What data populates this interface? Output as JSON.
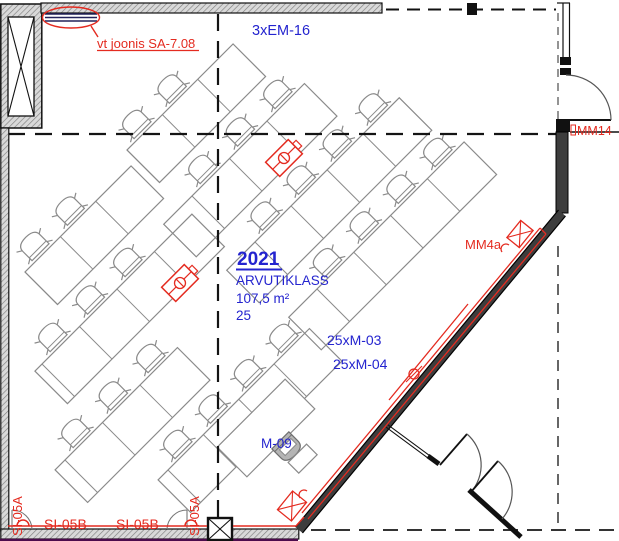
{
  "drawing": {
    "room": {
      "number": "2021",
      "name": "ARVUTIKLASS",
      "area": "107,5 m²",
      "seat_count": "25"
    },
    "annotations": {
      "reference_note": "vt joonis SA-7.08",
      "top_electrical_label": "3xEM-16",
      "right_door_label": "MM14",
      "wall_device_label": "MM4a",
      "equipment_label_1": "25xM-03",
      "equipment_label_2": "25xM-04",
      "teacher_desk_label": "M-09",
      "bottom_pipe_label_1": "SI-05B",
      "bottom_pipe_label_2": "SI-05B",
      "riser_label_left": "SI-05A",
      "riser_label_right": "SI-05A"
    },
    "colors": {
      "annotation_red": "#e42b20",
      "label_blue": "#2424cf",
      "wall_dark": "#3d3d3d",
      "furniture_gray": "#8a8a8a",
      "accent_purple": "#4c0b4c"
    }
  }
}
